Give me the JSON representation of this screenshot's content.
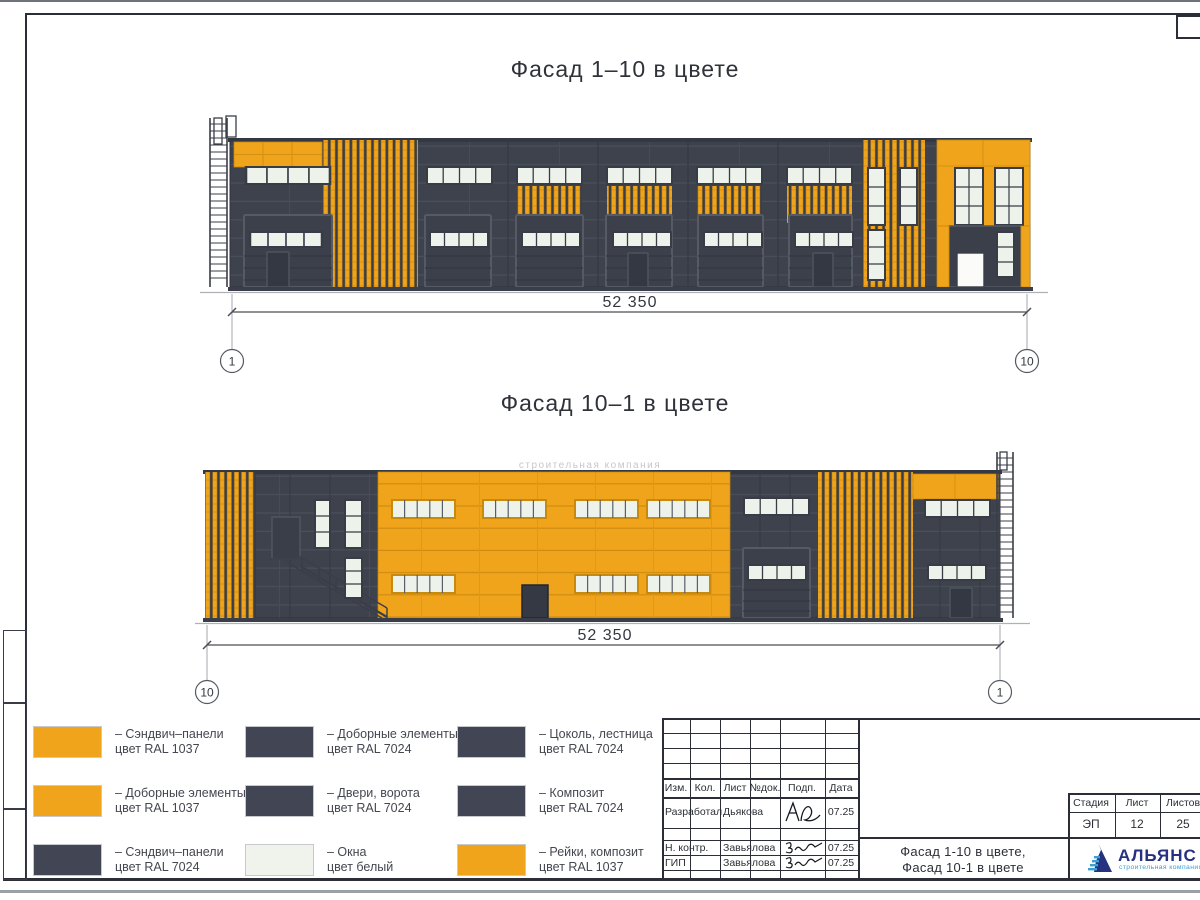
{
  "page": {
    "title_facade_1_10": "Фасад 1–10 в цвете",
    "title_facade_10_1": "Фасад 10–1 в цвете",
    "watermark": "строительная компания"
  },
  "facade1": {
    "dimension": "52 350",
    "axis_left": "1",
    "axis_right": "10"
  },
  "facade2": {
    "dimension": "52 350",
    "axis_left": "10",
    "axis_right": "1"
  },
  "legend": {
    "items": [
      {
        "color": "#F0A41B",
        "line1": "– Сэндвич–панели",
        "line2": "цвет RAL 1037"
      },
      {
        "color": "#414554",
        "line1": "– Доборные элементы",
        "line2": "цвет RAL 7024"
      },
      {
        "color": "#414554",
        "line1": "– Цоколь, лестница",
        "line2": "цвет RAL 7024"
      },
      {
        "color": "#F0A41B",
        "line1": "– Доборные элементы",
        "line2": "цвет RAL 1037"
      },
      {
        "color": "#414554",
        "line1": "– Двери, ворота",
        "line2": "цвет RAL 7024"
      },
      {
        "color": "#414554",
        "line1": "– Композит",
        "line2": "цвет RAL 7024"
      },
      {
        "color": "#414554",
        "line1": "– Сэндвич–панели",
        "line2": "цвет RAL 7024"
      },
      {
        "color": "#F0F3EC",
        "line1": "– Окна",
        "line2": "цвет белый"
      },
      {
        "color": "#F0A41B",
        "line1": "– Рейки, композит",
        "line2": "цвет RAL 1037"
      }
    ]
  },
  "titleblock": {
    "headers": {
      "izm": "Изм.",
      "kol": "Кол.",
      "list": "Лист",
      "ndok": "№док.",
      "podp": "Подп.",
      "data": "Дата"
    },
    "rows": [
      {
        "role": "Разработал",
        "name": "Дьякова",
        "date": "07.25"
      },
      {
        "role": "Н. контр.",
        "name": "Завьялова",
        "date": "07.25"
      },
      {
        "role": "ГИП",
        "name": "Завьялова",
        "date": "07.25"
      }
    ],
    "doc_title_line1": "Фасад 1-10 в цвете,",
    "doc_title_line2": "Фасад 10-1 в цвете",
    "stage_header": "Стадия",
    "sheet_header": "Лист",
    "sheets_header": "Листов",
    "stage": "ЭП",
    "sheet": "12",
    "sheets": "25",
    "logo_name": "АЛЬЯНС",
    "logo_subtitle": "строительная компания"
  },
  "colors": {
    "ral1037_orange": "#F0A41B",
    "ral7024_graphite": "#3E424D",
    "window_white": "#EDF2EA",
    "legend_dark": "#414554",
    "logo_blue": "#26317F",
    "logo_lightblue": "#3AA0D6"
  }
}
